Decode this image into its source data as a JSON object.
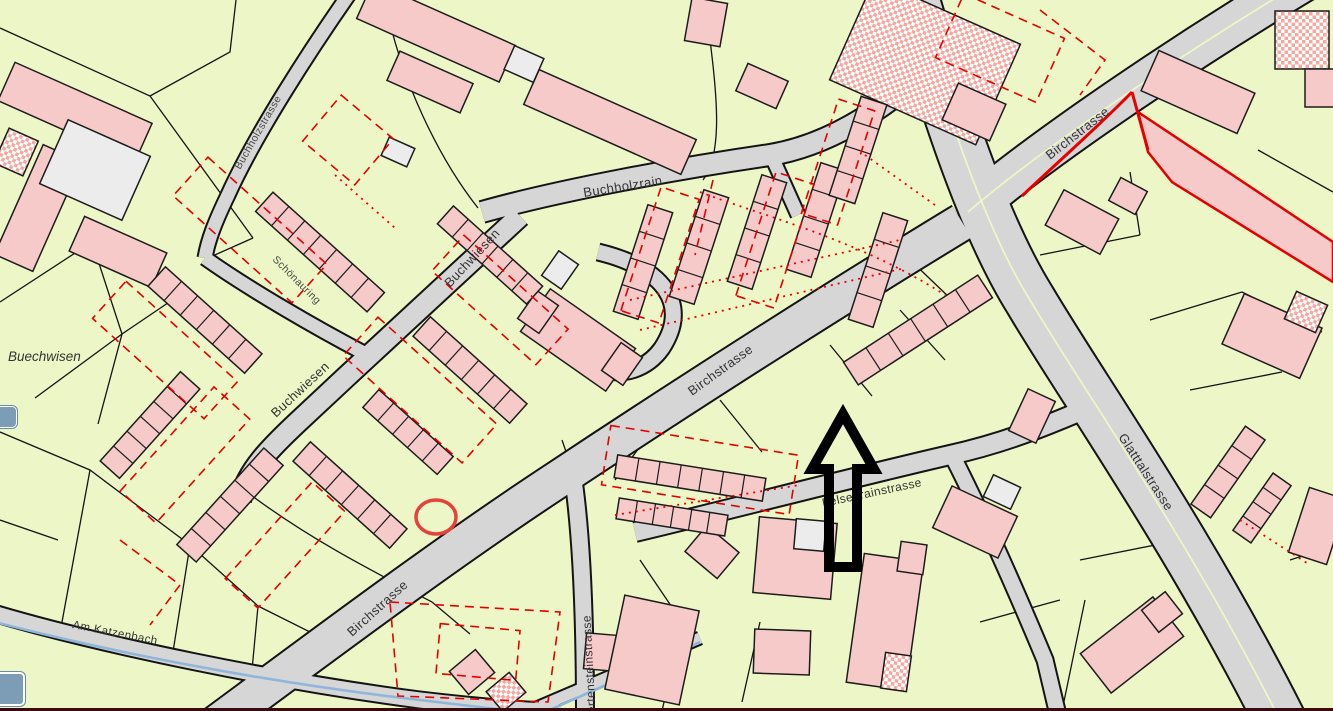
{
  "map": {
    "place_labels": {
      "buechwisen": "Buechwisen"
    },
    "street_labels": {
      "topleft_street": "Buchholzstrasse",
      "buchholzrain": "Buchholzrain",
      "schoenauring": "Schönauring",
      "buchwiesen_upper": "Buchwiesen",
      "buchwiesen_lower": "Buchwiesen",
      "birchstrasse_center": "Birchstrasse",
      "birchstrasse_lower": "Birchstrasse",
      "birchstrasse_upper": "Birchstrasse",
      "glatttalstrasse": "Glatttalstrasse",
      "felsenrainstrasse": "Felsenrainstrasse",
      "hertensteinstrasse": "Hertensteinstrasse",
      "am_katzenbach": "Am Katzenbach"
    },
    "annotations": {
      "arrow": "black-up-arrow-marker",
      "circle": "red-circle-marker",
      "route": "red-route-highlight"
    },
    "colors": {
      "background": "#edf6c6",
      "building_fill": "#f7caca",
      "building_outline": "#1c1c1c",
      "secondary_building_fill": "#ececec",
      "road_fill": "#d6d6d6",
      "road_casing": "#141414",
      "planned_red": "#e60000",
      "stream_blue": "#8fb6da",
      "annotation_black": "#000000",
      "annotation_red": "#e8403a",
      "ui_button": "#7d9cb5",
      "window_edge": "#380a0d"
    }
  }
}
